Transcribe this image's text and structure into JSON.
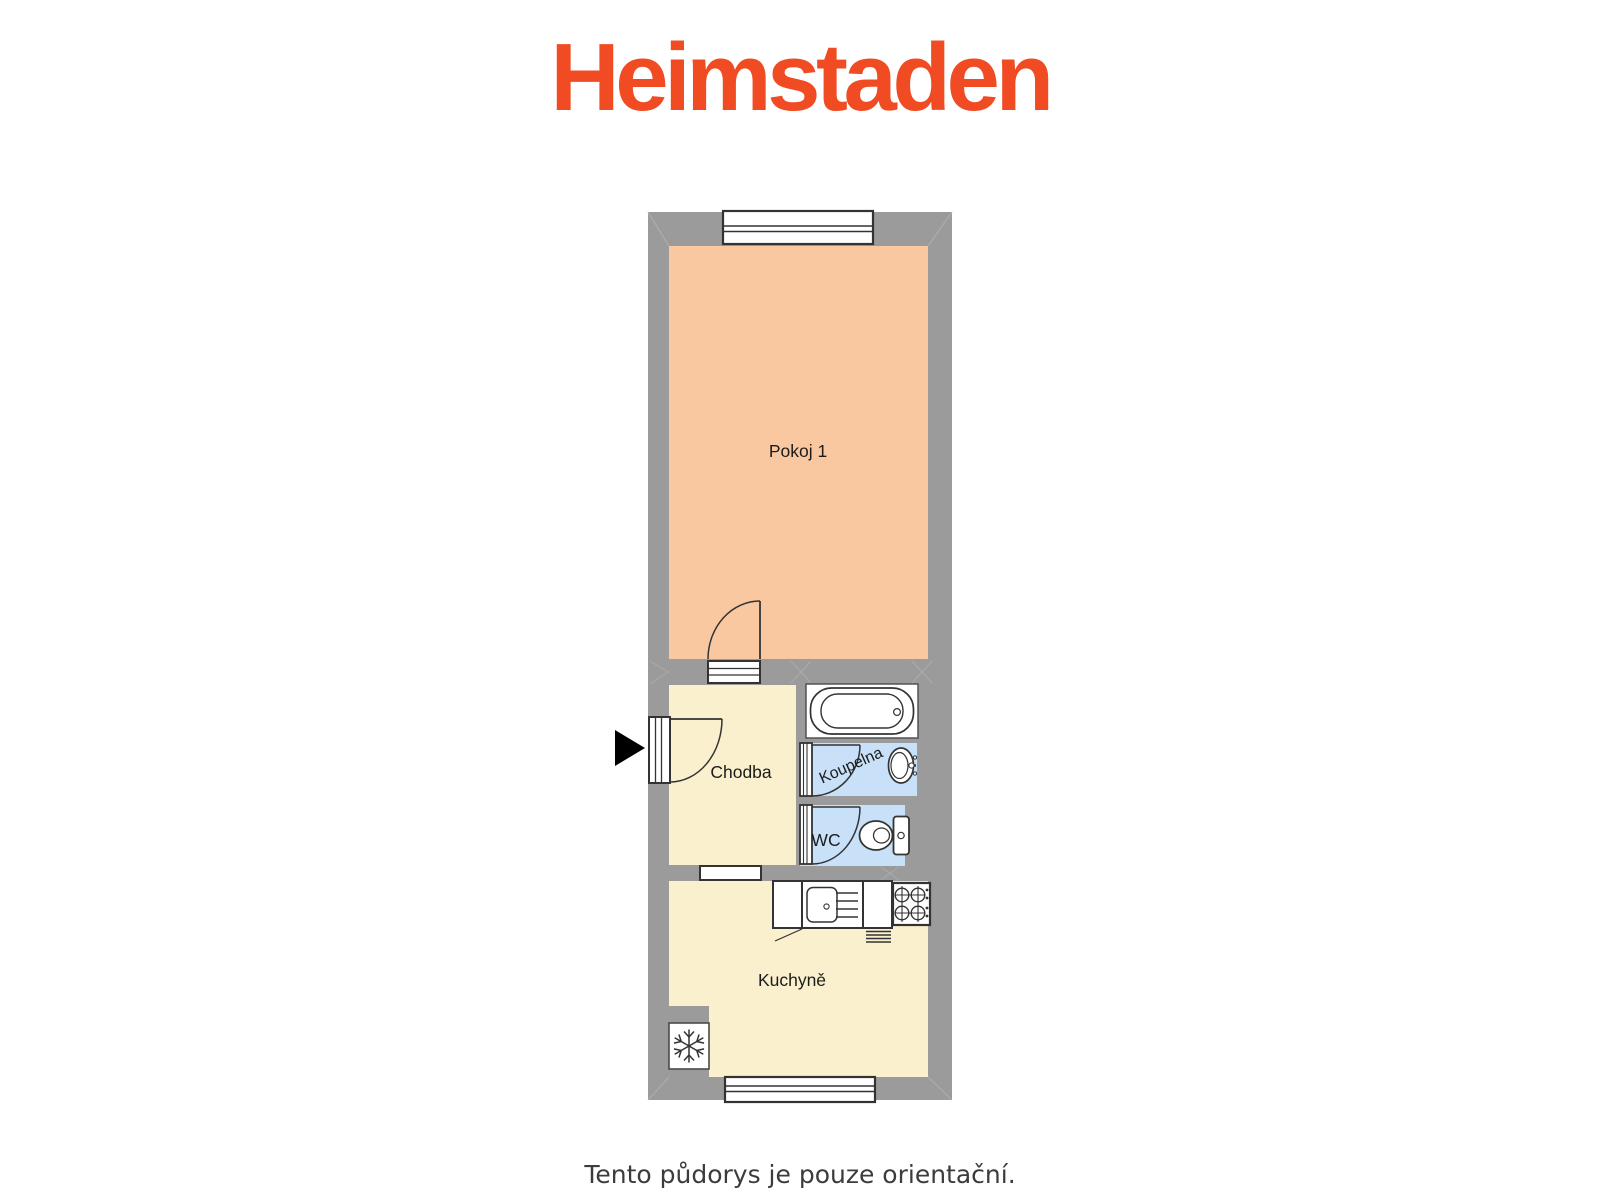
{
  "brand": {
    "name": "Heimstaden",
    "color": "#F04B23"
  },
  "caption": {
    "text": "Tento půdorys je pouze orientační."
  },
  "floorplan": {
    "wall_color": "#9B9B9B",
    "outline_color": "#333333",
    "rooms": {
      "pokoj1": {
        "label": "Pokoj 1",
        "color": "#FAC8A0"
      },
      "chodba": {
        "label": "Chodba",
        "color": "#FAF0CD"
      },
      "koupelna": {
        "label": "Koupelna",
        "color": "#C8E0F8"
      },
      "wc": {
        "label": "WC",
        "color": "#C8E0F8"
      },
      "kuchyne": {
        "label": "Kuchyně",
        "color": "#FAF0CD"
      }
    },
    "fixtures": {
      "bathtub": "bathtub-icon",
      "washbasin": "washbasin-icon",
      "toilet": "toilet-icon",
      "kitchen_sink": "kitchen-sink-icon",
      "stove": "stove-icon",
      "freezer": "freezer-icon"
    },
    "windows_count": 2,
    "entrance_marker": "arrow-right"
  }
}
